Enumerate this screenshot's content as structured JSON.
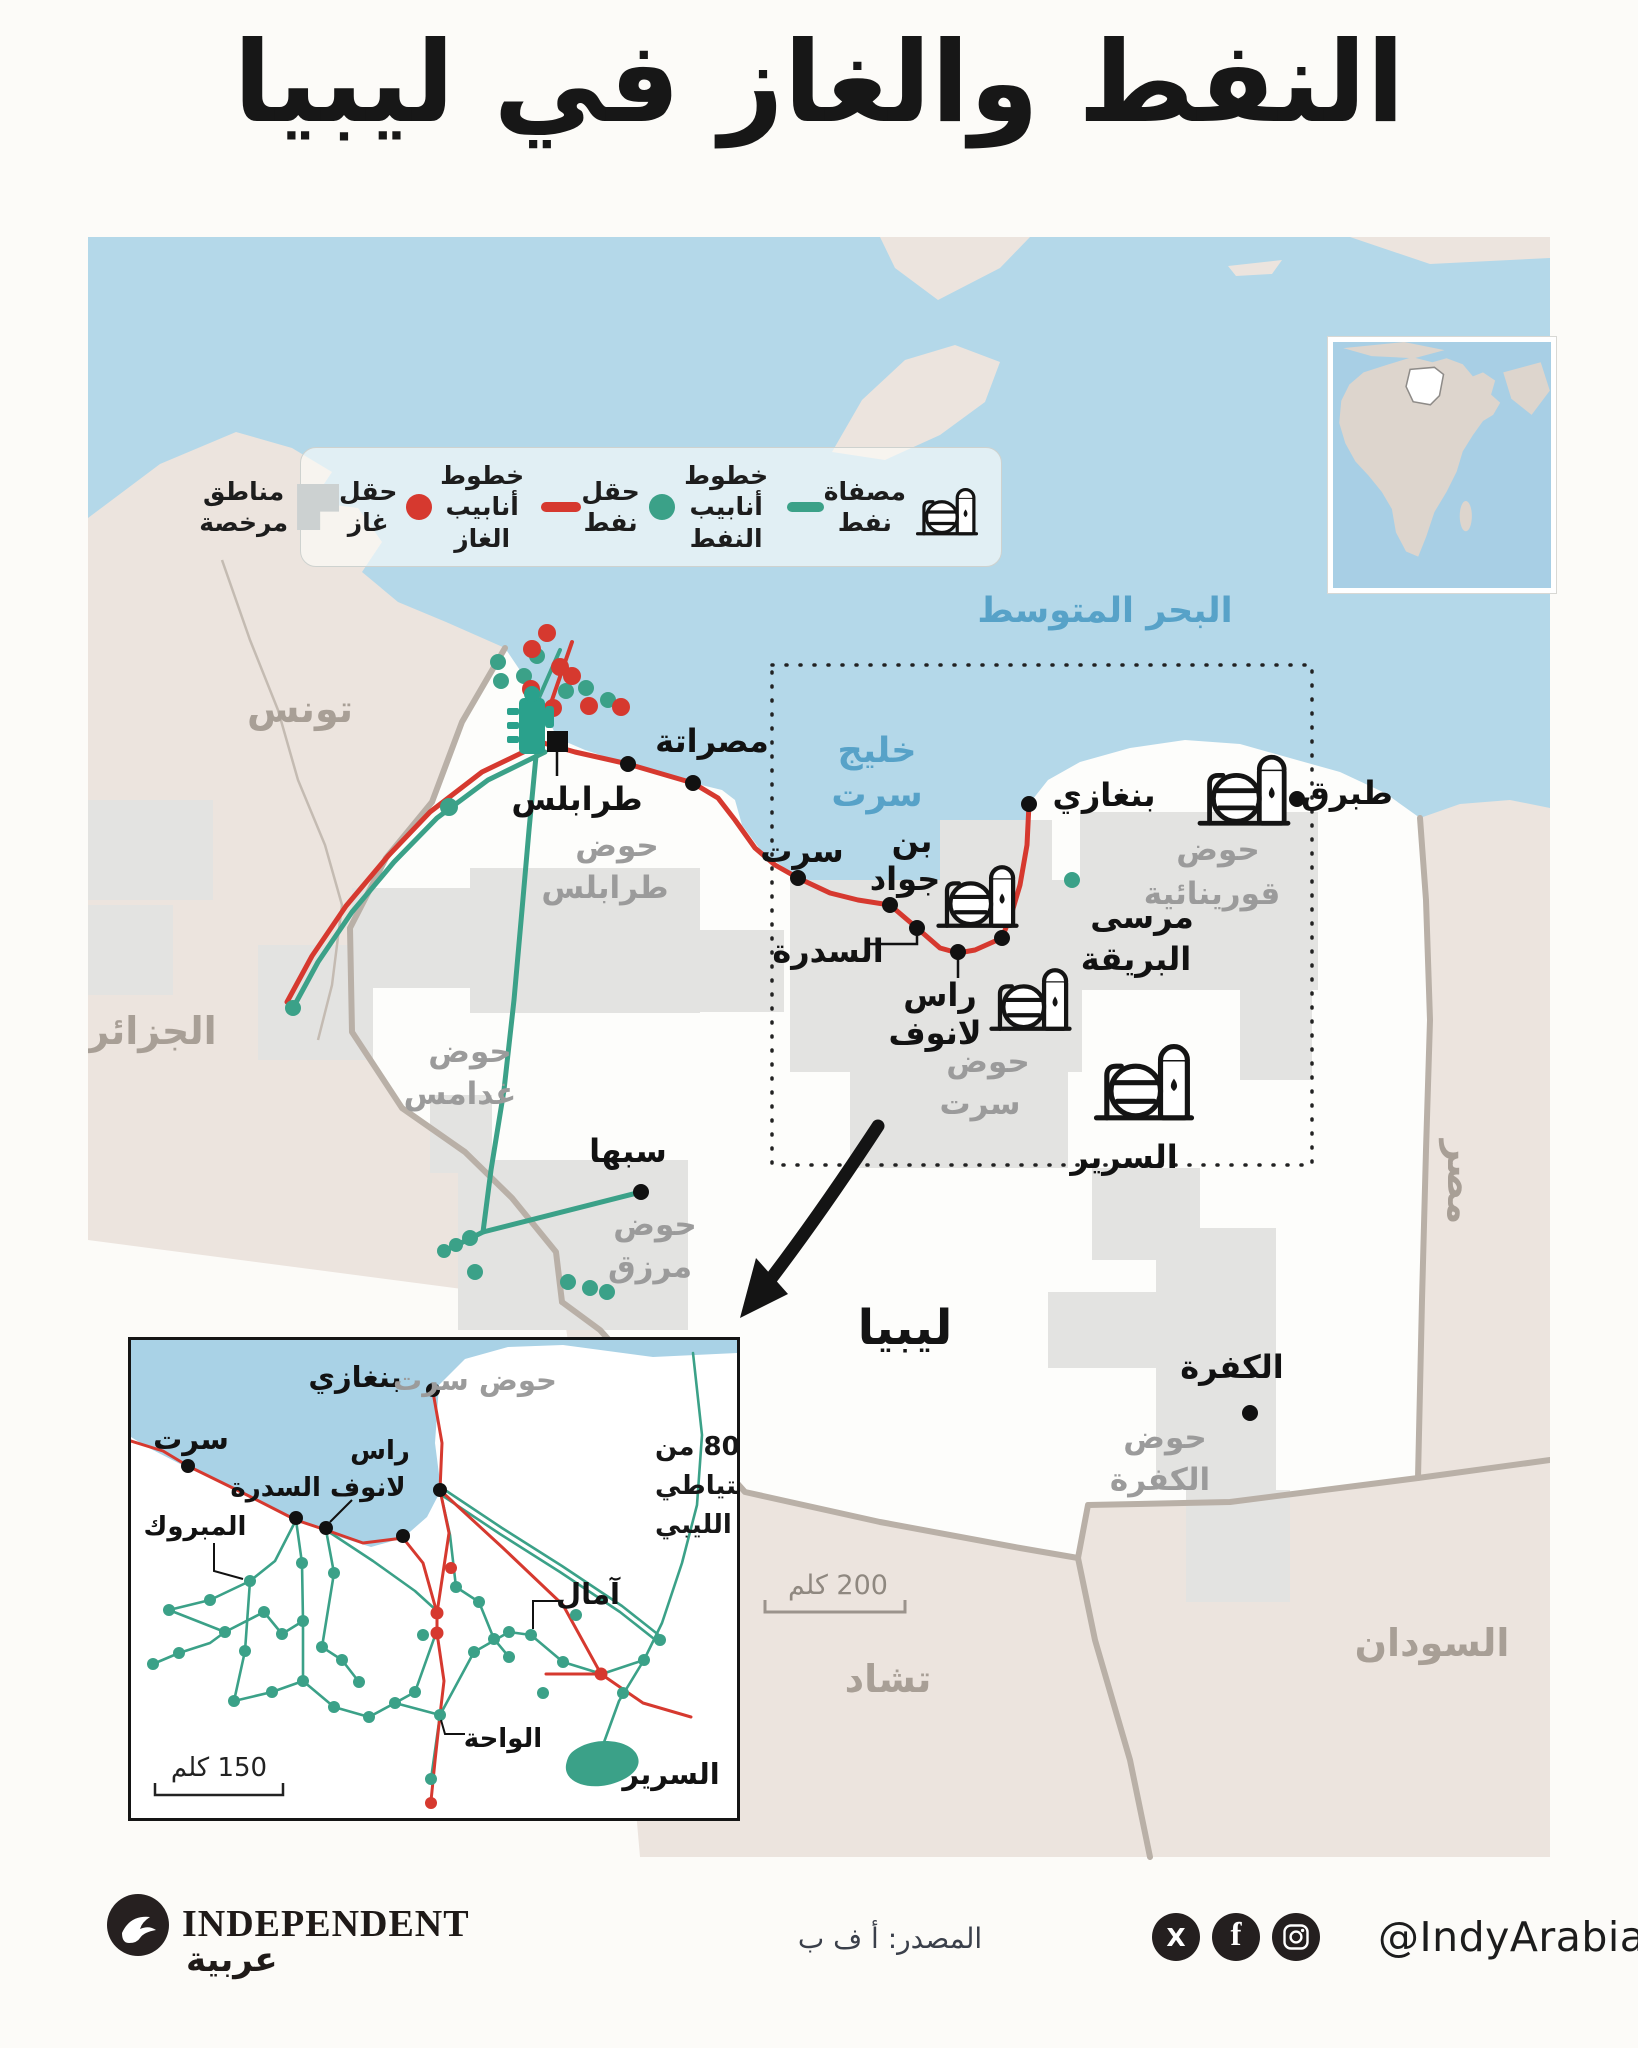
{
  "title": "النفط والغاز في ليبيا",
  "legend": {
    "refinery": {
      "line1": "مصفاة",
      "line2": "نفط"
    },
    "oil_pipeline": {
      "line1": "خطوط",
      "line2": "أنابيب النفط"
    },
    "oil_field": {
      "line1": "حقل",
      "line2": "نفط"
    },
    "gas_pipeline": {
      "line1": "خطوط",
      "line2": "أنابيب الغاز"
    },
    "gas_field": {
      "line1": "حقل",
      "line2": "غاز"
    },
    "licensed_area": {
      "line1": "مناطق",
      "line2": "مرخصة"
    }
  },
  "map": {
    "mediterranean_label": "البحر المتوسط",
    "gulf_line1": "خليج",
    "gulf_line2": "سرت",
    "libya_label": "ليبيا",
    "scale_label": "200 كلم",
    "countries": [
      {
        "label": "تونس"
      },
      {
        "label": "الجزائر"
      },
      {
        "label": "مصر"
      },
      {
        "label": "السودان"
      },
      {
        "label": "تشاد"
      }
    ],
    "cities": [
      {
        "label": "طرابلس"
      },
      {
        "label": "مصراتة"
      },
      {
        "label": "سرت"
      },
      {
        "line1": "بن",
        "line2": "جواد"
      },
      {
        "label": "السدرة"
      },
      {
        "line1": "راس",
        "line2": "لانوف"
      },
      {
        "line1": "مرسى",
        "line2": "البريقة"
      },
      {
        "label": "بنغازي"
      },
      {
        "label": "طبرق"
      },
      {
        "label": "سبها"
      },
      {
        "label": "الكفرة"
      },
      {
        "label": "السرير"
      }
    ],
    "basins": [
      {
        "line1": "حوض",
        "line2": "طرابلس"
      },
      {
        "line1": "حوض",
        "line2": "غدامس"
      },
      {
        "line1": "حوض",
        "line2": "مرزق"
      },
      {
        "line1": "حوض",
        "line2": "سرت"
      },
      {
        "line1": "حوض",
        "line2": "قورينائية"
      },
      {
        "line1": "حوض",
        "line2": "الكفرة"
      }
    ]
  },
  "inset": {
    "basin_label": "حوض سرت",
    "note_line1": "80٪ من",
    "note_line2": "الاحتياطي",
    "note_line3": "النفطي الليبي",
    "scale_label": "150 كلم",
    "cities": [
      {
        "label": "بنغازي"
      },
      {
        "label": "سرت"
      },
      {
        "line1": "راس",
        "line2": "لانوف السدرة"
      },
      {
        "label": "المبروك"
      },
      {
        "label": "آمال"
      },
      {
        "label": "الواحة"
      },
      {
        "label": "السرير"
      }
    ]
  },
  "footer": {
    "brand_name": "INDEPENDENT",
    "brand_arabic": "عربية",
    "source": "المصدر: أ ف ب",
    "handle": "@IndyArabia",
    "social_icons": [
      "x",
      "facebook",
      "instagram"
    ]
  },
  "colors": {
    "oil_green": "#3ba188",
    "gas_red": "#d6392f",
    "sea_blue": "#b4d8e9",
    "neighbor_land": "#ece4de",
    "libya_fill": "#fdfdfb",
    "licensed_gray": "#e3e3e1",
    "border_gray": "#b9b0a7",
    "basin_text": "#9b9b9b",
    "country_text": "#a89f96",
    "sea_text": "#57a2c8",
    "ink": "#161616"
  }
}
